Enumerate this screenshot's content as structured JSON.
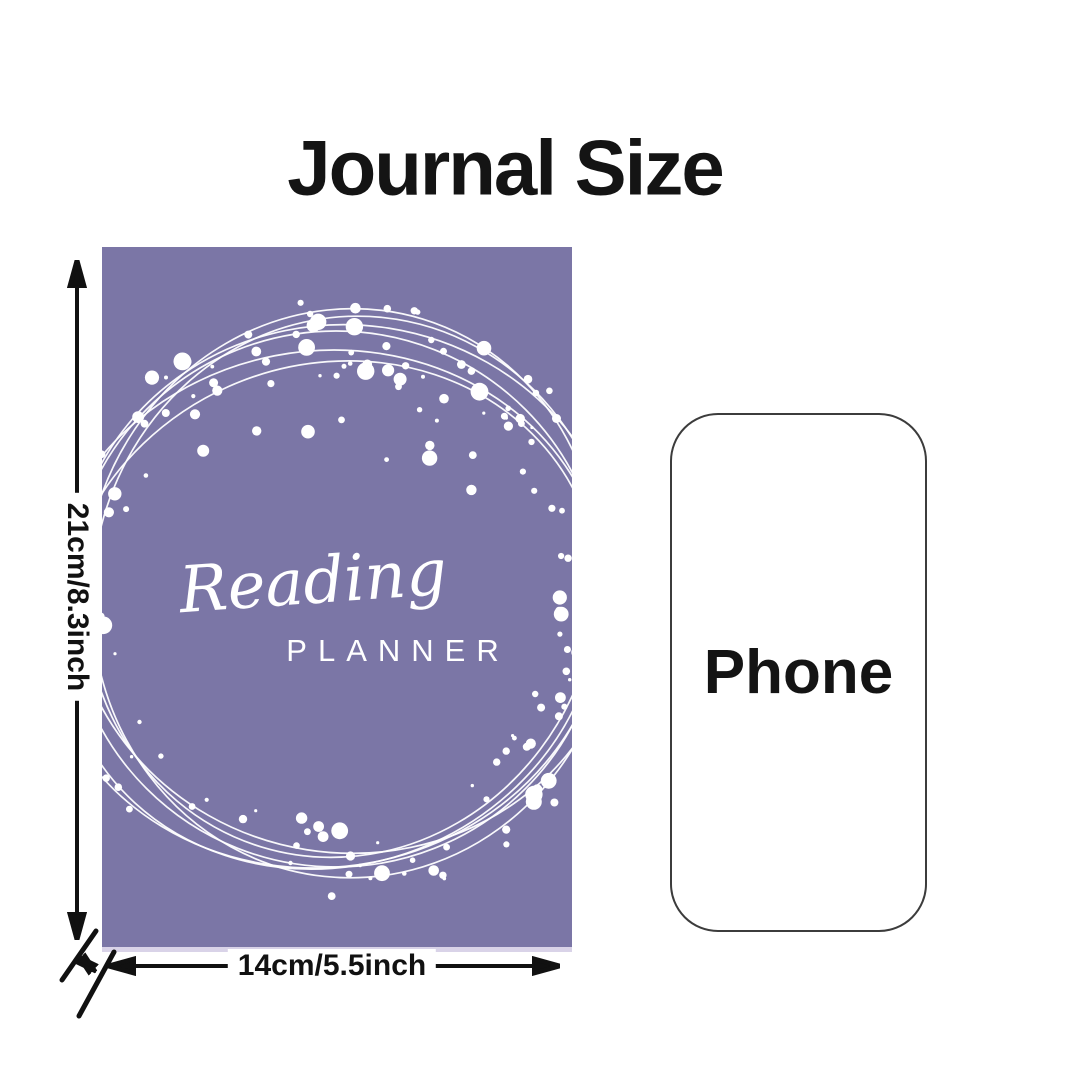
{
  "title": "Journal Size",
  "journal": {
    "cover_title_script": "Reading",
    "cover_subtitle": "PLANNER",
    "cover_color": "#7b76a6",
    "height_label": "21cm/8.3inch",
    "width_label": "14cm/5.5inch"
  },
  "phone": {
    "label": "Phone"
  },
  "colors": {
    "annotation": "#111111",
    "cover_edge": "#d9d3e8",
    "phone_border": "#3c3c3c"
  }
}
